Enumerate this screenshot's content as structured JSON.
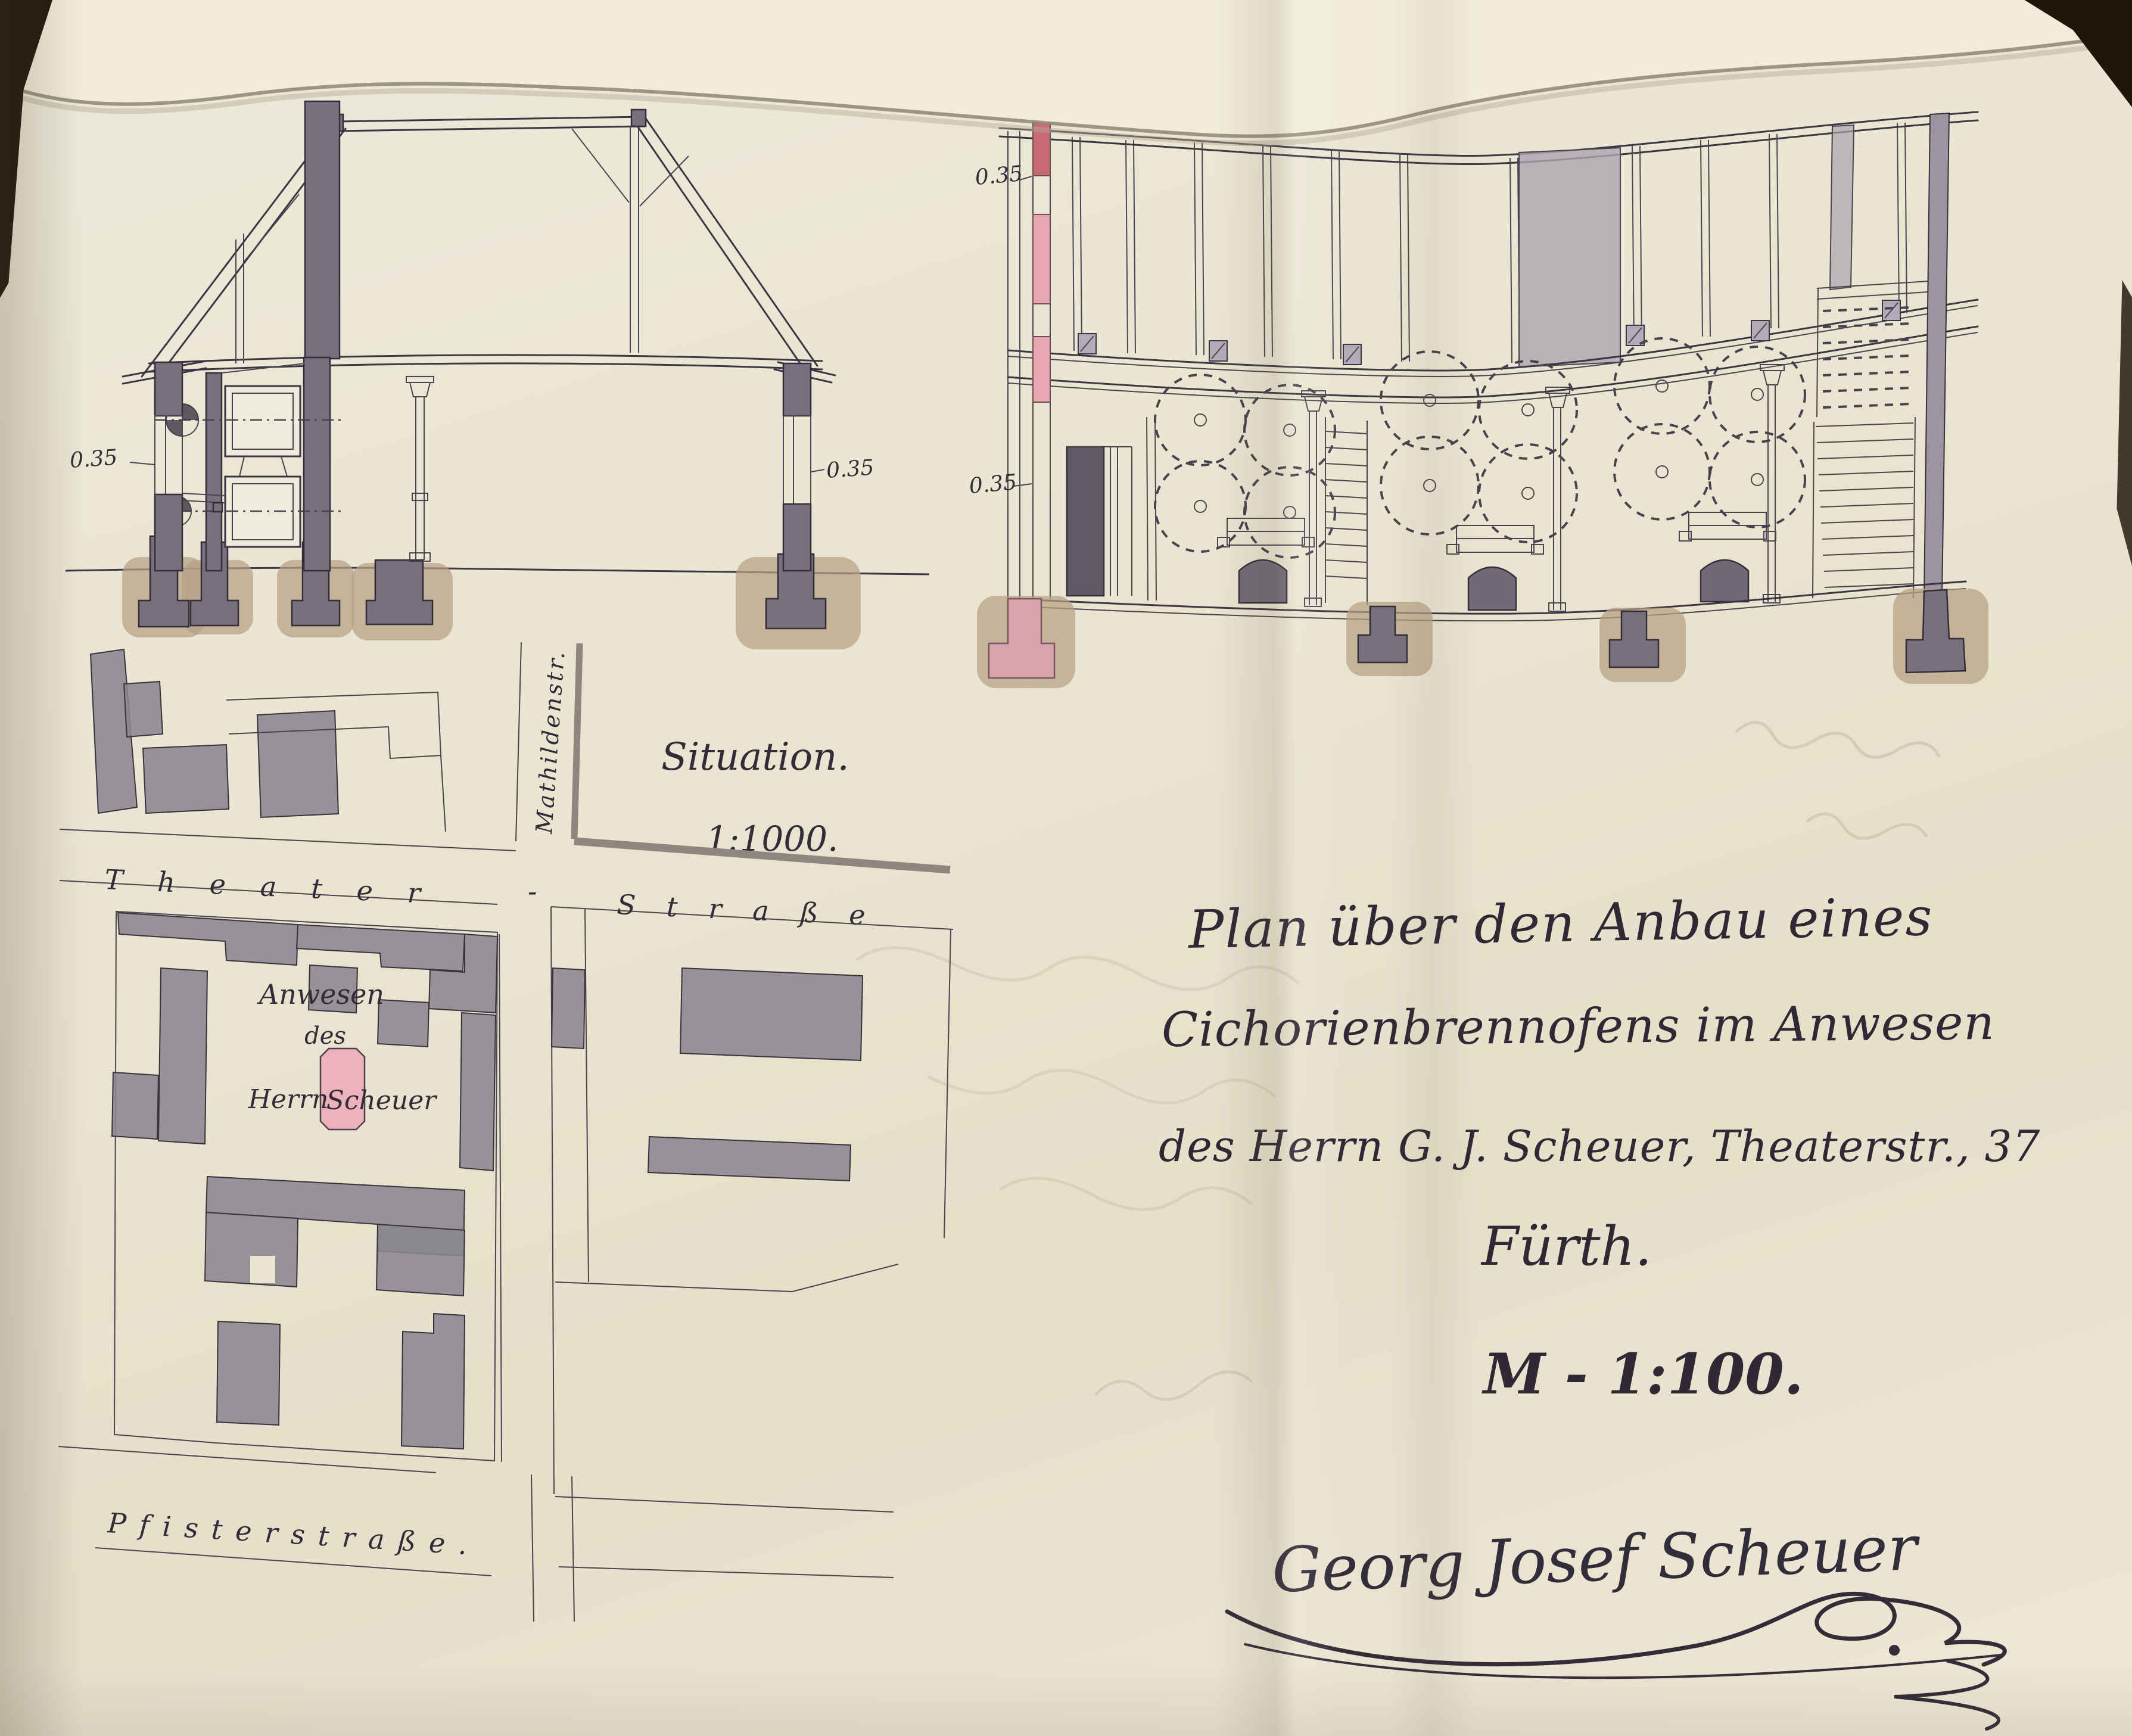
{
  "cross_section": {
    "dim_left": "0.35",
    "dim_right": "0.35"
  },
  "long_section": {
    "dim_upper": "0.35",
    "dim_lower": "0.35"
  },
  "site_plan": {
    "label": "Situation.",
    "scale": "1:1000.",
    "street_theater_1": "Theater",
    "street_theater_sep": "-",
    "street_theater_2": "Straße",
    "street_mathilden": "Mathildenstr.",
    "street_pfister": "Pfisterstraße.",
    "property_line1": "Anwesen",
    "property_line2": "des",
    "property_line3": "Herrn",
    "property_owner": "Scheuer"
  },
  "title_block": {
    "line1": "Plan über den Anbau eines",
    "line2": "Cichorienbrennofens im Anwesen",
    "line3": "des Herrn G. J. Scheuer, Theaterstr., 37",
    "line4": "Fürth.",
    "scale": "M - 1:100."
  },
  "signature": {
    "name": "Georg Josef Scheuer"
  },
  "colors": {
    "paper": "#eae5d1",
    "ink": "#3a3540",
    "wall_gray": "#77707f",
    "plan_building_gray": "#8b8690",
    "new_pink": "#e7a6b1",
    "new_red": "#c96a77",
    "foundation_tan": "#b5a184"
  }
}
